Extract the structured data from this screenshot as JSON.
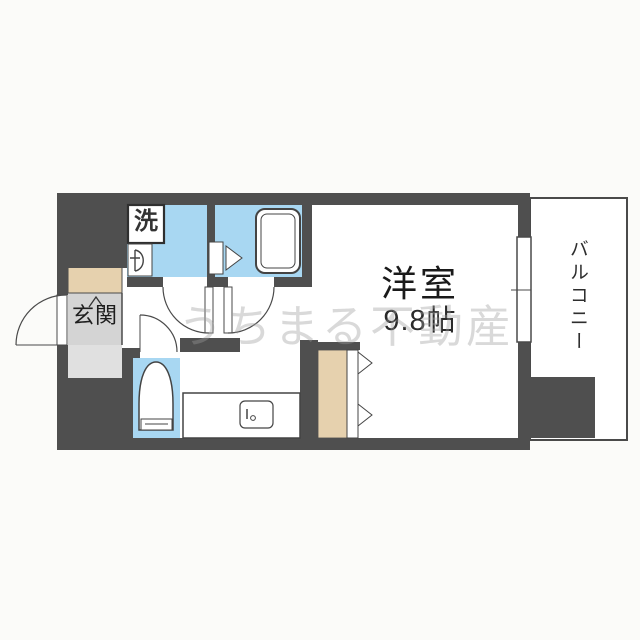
{
  "floorplan": {
    "labels": {
      "laundry": "洗",
      "genkan": "玄関",
      "room": "洋室",
      "room_size": "9.8帖",
      "balcony": "バルコニー"
    },
    "watermark": "うちまる不動産",
    "colors": {
      "wall": "#4f4f4f",
      "line": "#4a4a4a",
      "water_area_blue": "#a8d7f2",
      "wood_area_beige": "#e6d1ae",
      "genkan_floor_gray": "#d4d4d4",
      "genkan_step_gray": "#e0e0e0",
      "floor_white": "#ffffff",
      "background": "#fbfbf9"
    },
    "fixtures": [
      "washing-machine",
      "washbasin",
      "bathtub",
      "bath-door",
      "toilet",
      "kitchen-counter",
      "kitchen-sink",
      "closet-folding-doors",
      "entrance-door",
      "washroom-door",
      "room-door",
      "toilet-door",
      "balcony-window"
    ]
  }
}
